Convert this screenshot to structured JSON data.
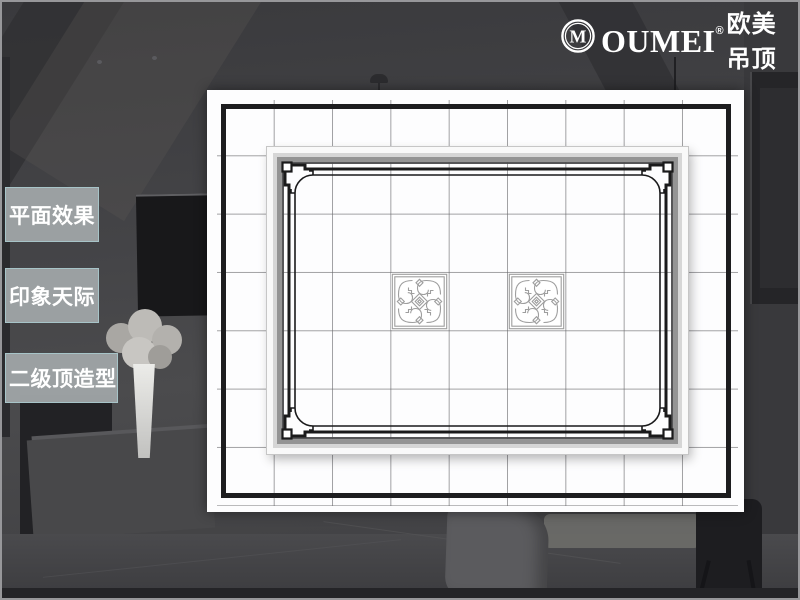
{
  "logo": {
    "mark_letter": "M",
    "brand_latin": "OUMEI",
    "registered": "®",
    "brand_cn": "欧美吊顶"
  },
  "sidebar": {
    "items": [
      {
        "label": "平面效果"
      },
      {
        "label": "印象天际"
      },
      {
        "label": "二级顶造型"
      }
    ]
  },
  "ceiling_plan": {
    "description_visible": "plan view of a gridded ceiling with a raised second-level center panel and two ornamental tiles",
    "grid": {
      "cell_size_px": 58,
      "line_color": "#8f8f8f"
    },
    "outer_frame_color": "#1d1d1f",
    "inner_frame": {
      "band_colors": [
        "#ffffff",
        "#dbdbdb",
        "#989898",
        "#4c4c4e"
      ],
      "decor_border_color": "#1a1a1b"
    },
    "ornament_tiles": {
      "count": 2,
      "stroke_color": "#9e9e9e"
    }
  },
  "colors": {
    "page_background": "#434346",
    "button_fill": "#9ea3a5",
    "button_border": "#a8c8cc",
    "text": "#ffffff"
  }
}
